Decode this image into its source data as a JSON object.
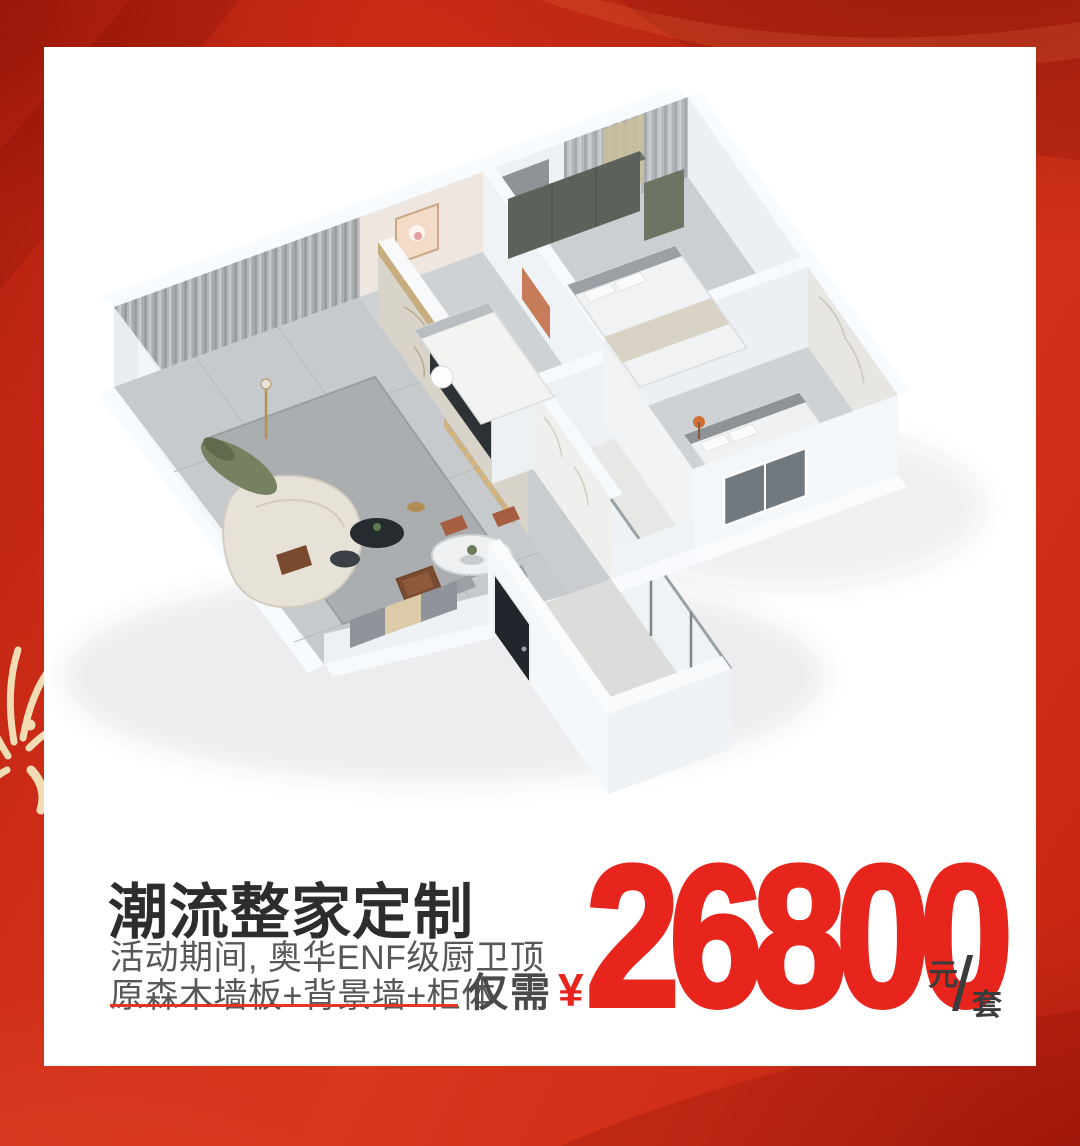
{
  "background": {
    "base_red": "#cd2c17",
    "dark_red": "#8f1205",
    "firework_color": "#f2dcb4",
    "icons": {
      "firework": "firework-icon"
    }
  },
  "card": {
    "illustration": "apartment-3d-render",
    "title": "潮流整家定制",
    "subtitle_line1": "活动期间, 奥华ENF级厨卫顶",
    "subtitle_line2": "原森木墙板+背景墙+柜体",
    "price": {
      "prefix": "仅需",
      "currency": "¥",
      "amount": "26800",
      "unit_top": "元",
      "unit_slash": "/",
      "unit_bottom": "套",
      "accent_red": "#e7251c",
      "dark_text": "#3b3b3b"
    }
  }
}
